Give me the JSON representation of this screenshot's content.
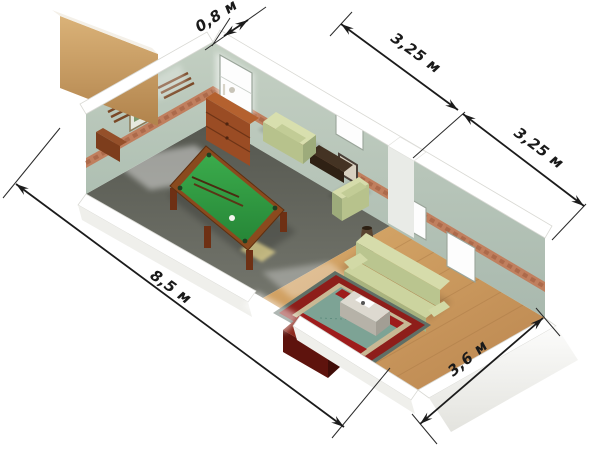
{
  "figure": {
    "type": "isometric-floor-plan",
    "description_objects": [
      "billiard-table",
      "sideboard",
      "armchair",
      "armchair",
      "sofa",
      "rug",
      "coffee-table",
      "tv-cabinet",
      "console-table",
      "vase",
      "windows",
      "picture-frames",
      "cue-racks"
    ]
  },
  "dimensions": [
    {
      "id": "entry-wall-width",
      "label": "0,8 м"
    },
    {
      "id": "top-wall-section-1",
      "label": "3,25 м"
    },
    {
      "id": "top-wall-section-2",
      "label": "3,25 м"
    },
    {
      "id": "room-length",
      "label": "8,5 м"
    },
    {
      "id": "room-width",
      "label": "3,6 м"
    }
  ],
  "colors": {
    "background": "#ffffff",
    "dark_floor": "#5a5c55",
    "wood_floor": "#cc9a5e",
    "wall_sage": "#b9c7ba",
    "wallpaper_border": "#c07f5e",
    "billiard_felt": "#2fa040",
    "billiard_frame": "#8a4a1e",
    "sofa_green": "#ccd49f",
    "sofa_green_light": "#d8dfae",
    "rug_red": "#8e1e1a",
    "rug_teal": "#7da395",
    "cabinet_red": "#5e130d",
    "sideboard_brown": "#9a4c24",
    "tan_wall": "#c89c64",
    "dimension_ink": "#1b1b1b"
  }
}
